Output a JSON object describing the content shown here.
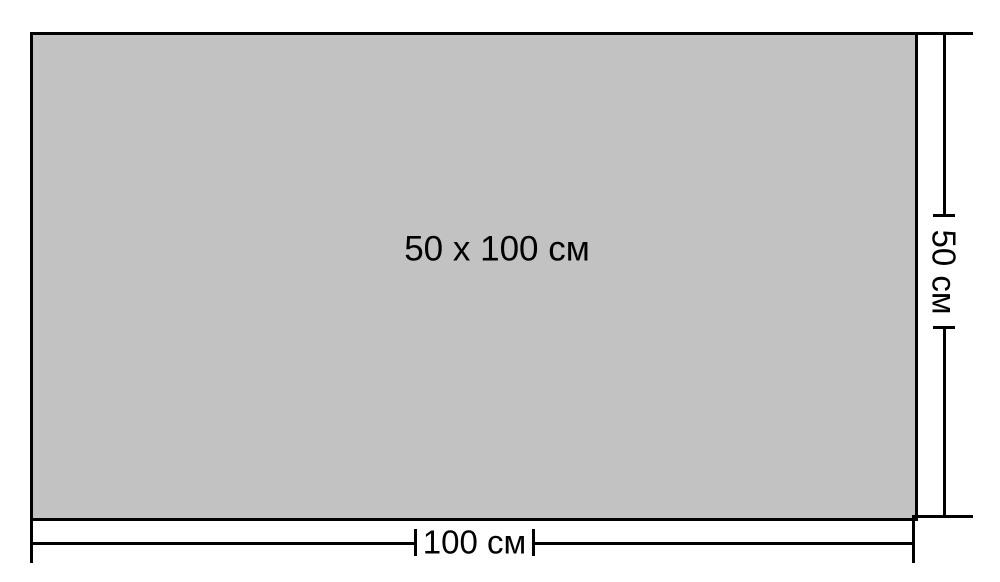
{
  "figure": {
    "type": "dimension-diagram",
    "center_label": "50 x 100 см",
    "width_label": "100 см",
    "height_label": "50 см",
    "dimensions": {
      "width_cm": 100,
      "height_cm": 50,
      "unit": "см"
    },
    "colors": {
      "background": "#ffffff",
      "rect_fill": "#c2c2c2",
      "line": "#000000",
      "text": "#000000"
    }
  }
}
